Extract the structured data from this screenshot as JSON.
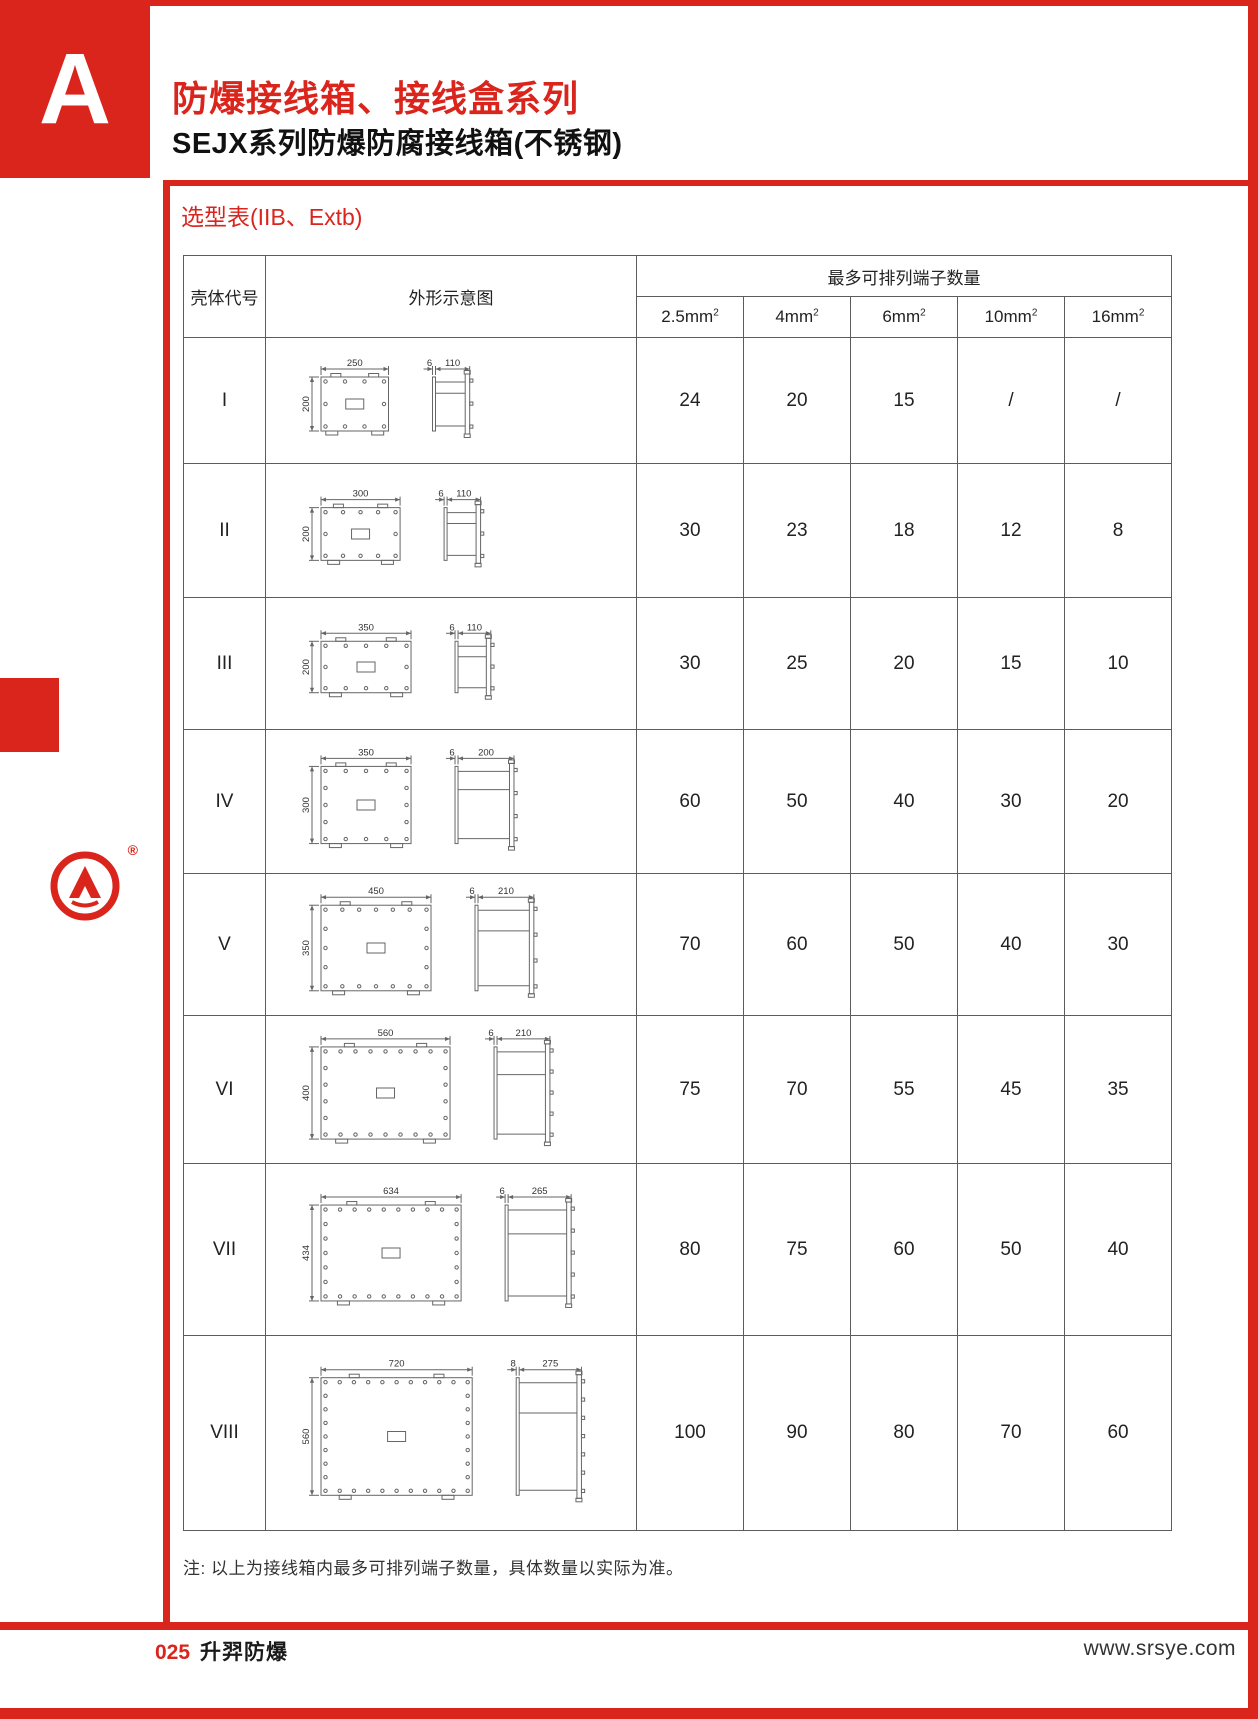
{
  "page": {
    "section_letter": "A",
    "title": "防爆接线箱、接线盒系列",
    "subtitle": "SEJX系列防爆防腐接线箱(不锈钢)",
    "table_title": "选型表(IIB、Extb)",
    "note": "注: 以上为接线箱内最多可排列端子数量，具体数量以实际为准。",
    "footer": {
      "page_number": "025",
      "company": "升羿防爆",
      "website": "www.srsye.com"
    },
    "logo_registered_mark": "®",
    "colors": {
      "accent_red": "#DA251D",
      "table_line": "#5c5c5c",
      "drawing_line": "#666666"
    }
  },
  "table": {
    "headers": {
      "shell_code": "壳体代号",
      "diagram": "外形示意图",
      "terminals_group": "最多可排列端子数量",
      "terminal_columns": [
        {
          "label": "2.5mm",
          "sup": "2"
        },
        {
          "label": "4mm",
          "sup": "2"
        },
        {
          "label": "6mm",
          "sup": "2"
        },
        {
          "label": "10mm",
          "sup": "2"
        },
        {
          "label": "16mm",
          "sup": "2"
        }
      ]
    },
    "rows": [
      {
        "code": "I",
        "dims": {
          "width": 250,
          "height": 200,
          "lid": 6,
          "depth": 110
        },
        "terminal_counts": [
          "24",
          "20",
          "15",
          "/",
          "/"
        ]
      },
      {
        "code": "II",
        "dims": {
          "width": 300,
          "height": 200,
          "lid": 6,
          "depth": 110
        },
        "terminal_counts": [
          "30",
          "23",
          "18",
          "12",
          "8"
        ]
      },
      {
        "code": "III",
        "dims": {
          "width": 350,
          "height": 200,
          "lid": 6,
          "depth": 110
        },
        "terminal_counts": [
          "30",
          "25",
          "20",
          "15",
          "10"
        ]
      },
      {
        "code": "IV",
        "dims": {
          "width": 350,
          "height": 300,
          "lid": 6,
          "depth": 200
        },
        "terminal_counts": [
          "60",
          "50",
          "40",
          "30",
          "20"
        ]
      },
      {
        "code": "V",
        "dims": {
          "width": 450,
          "height": 350,
          "lid": 6,
          "depth": 210
        },
        "terminal_counts": [
          "70",
          "60",
          "50",
          "40",
          "30"
        ]
      },
      {
        "code": "VI",
        "dims": {
          "width": 560,
          "height": 400,
          "lid": 6,
          "depth": 210
        },
        "terminal_counts": [
          "75",
          "70",
          "55",
          "45",
          "35"
        ]
      },
      {
        "code": "VII",
        "dims": {
          "width": 634,
          "height": 434,
          "lid": 6,
          "depth": 265
        },
        "terminal_counts": [
          "80",
          "75",
          "60",
          "50",
          "40"
        ]
      },
      {
        "code": "VIII",
        "dims": {
          "width": 720,
          "height": 560,
          "lid": 8,
          "depth": 275
        },
        "terminal_counts": [
          "100",
          "90",
          "80",
          "70",
          "60"
        ]
      }
    ]
  }
}
